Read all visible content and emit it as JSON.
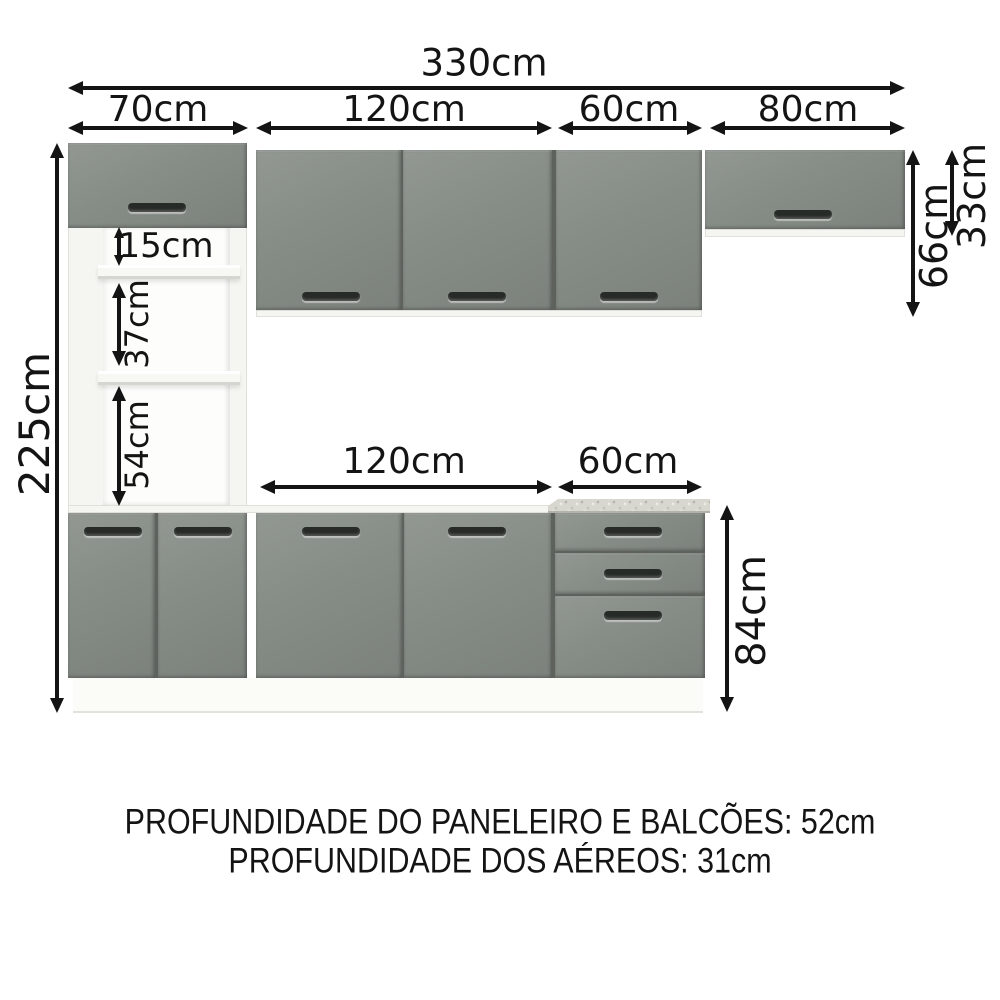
{
  "labels": {
    "total_width": "330cm",
    "top_70": "70cm",
    "top_120": "120cm",
    "top_60": "60cm",
    "top_80": "80cm",
    "gap_15": "15cm",
    "gap_37": "37cm",
    "gap_54": "54cm",
    "height_225": "225cm",
    "height_66": "66cm",
    "height_33": "33cm",
    "base_120": "120cm",
    "base_60": "60cm",
    "height_84": "84cm"
  },
  "notes": {
    "line1": "PROFUNDIDADE DO PANELEIRO E BALCÕES: 52cm",
    "line2": "PROFUNDIDADE DOS AÉREOS: 31cm"
  },
  "colors": {
    "background": "#ffffff",
    "ink": "#141414",
    "door": "#868c86",
    "door_dark": "#5d625d",
    "handle": "#272b27",
    "carcass": "#f5f5f1",
    "carcass_line": "#e0e0da",
    "granite": "#d7d7d0"
  }
}
